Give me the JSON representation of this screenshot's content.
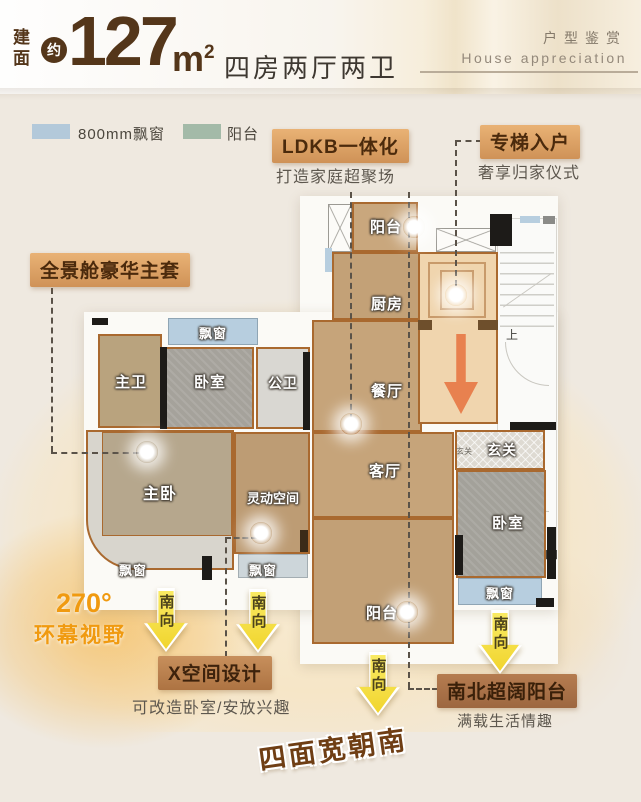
{
  "header": {
    "area_label": "建面",
    "approx_badge": "约",
    "area_value": "127",
    "area_unit": "m",
    "area_unit_sup": "2",
    "layout_text": "四房两厅两卫",
    "section_title_cn": "户型鉴赏",
    "section_title_en": "House appreciation"
  },
  "legend": {
    "bay_window": "800mm飘窗",
    "balcony": "阳台"
  },
  "callouts": {
    "ldkb_title": "LDKB一体化",
    "ldkb_subtitle": "打造家庭超聚场",
    "elevator_title": "专梯入户",
    "elevator_subtitle": "奢享归家仪式",
    "master_suite_title": "全景舱豪华主套",
    "view_degree": "270°",
    "view_text": "环幕视野",
    "xspace_title": "X空间设计",
    "xspace_subtitle": "可改造卧室/安放兴趣",
    "ns_balcony_title": "南北超阔阳台",
    "ns_balcony_subtitle": "满载生活情趣",
    "banner": "四面宽朝南",
    "south_arrow": "南向"
  },
  "rooms": {
    "balcony_top": "阳台",
    "kitchen": "厨房",
    "dining": "餐厅",
    "living": "客厅",
    "balcony_bottom": "阳台",
    "master_bath": "主卫",
    "bedroom_left": "卧室",
    "public_bath": "公卫",
    "master_bedroom": "主卧",
    "flex_space": "灵动空间",
    "foyer": "玄关",
    "foyer_small": "玄关",
    "bedroom_right": "卧室",
    "bay_window_top": "飘窗",
    "bay_window_master": "飘窗",
    "bay_window_flex": "飘窗",
    "bay_window_right": "飘窗",
    "stairs_up": "上"
  },
  "colors": {
    "title_brown": "#54361a",
    "highlight_tan": "#d99b5e",
    "deep_tan": "#aa7248",
    "legend_bay_blue": "#b3c9da",
    "legend_balcony_green": "#a3baa8",
    "south_arrow_yellow": "#f6e045",
    "route_arrow_orange": "#e8814f",
    "view_orange": "#f09a10",
    "floor_tan": "#c7a47b"
  }
}
